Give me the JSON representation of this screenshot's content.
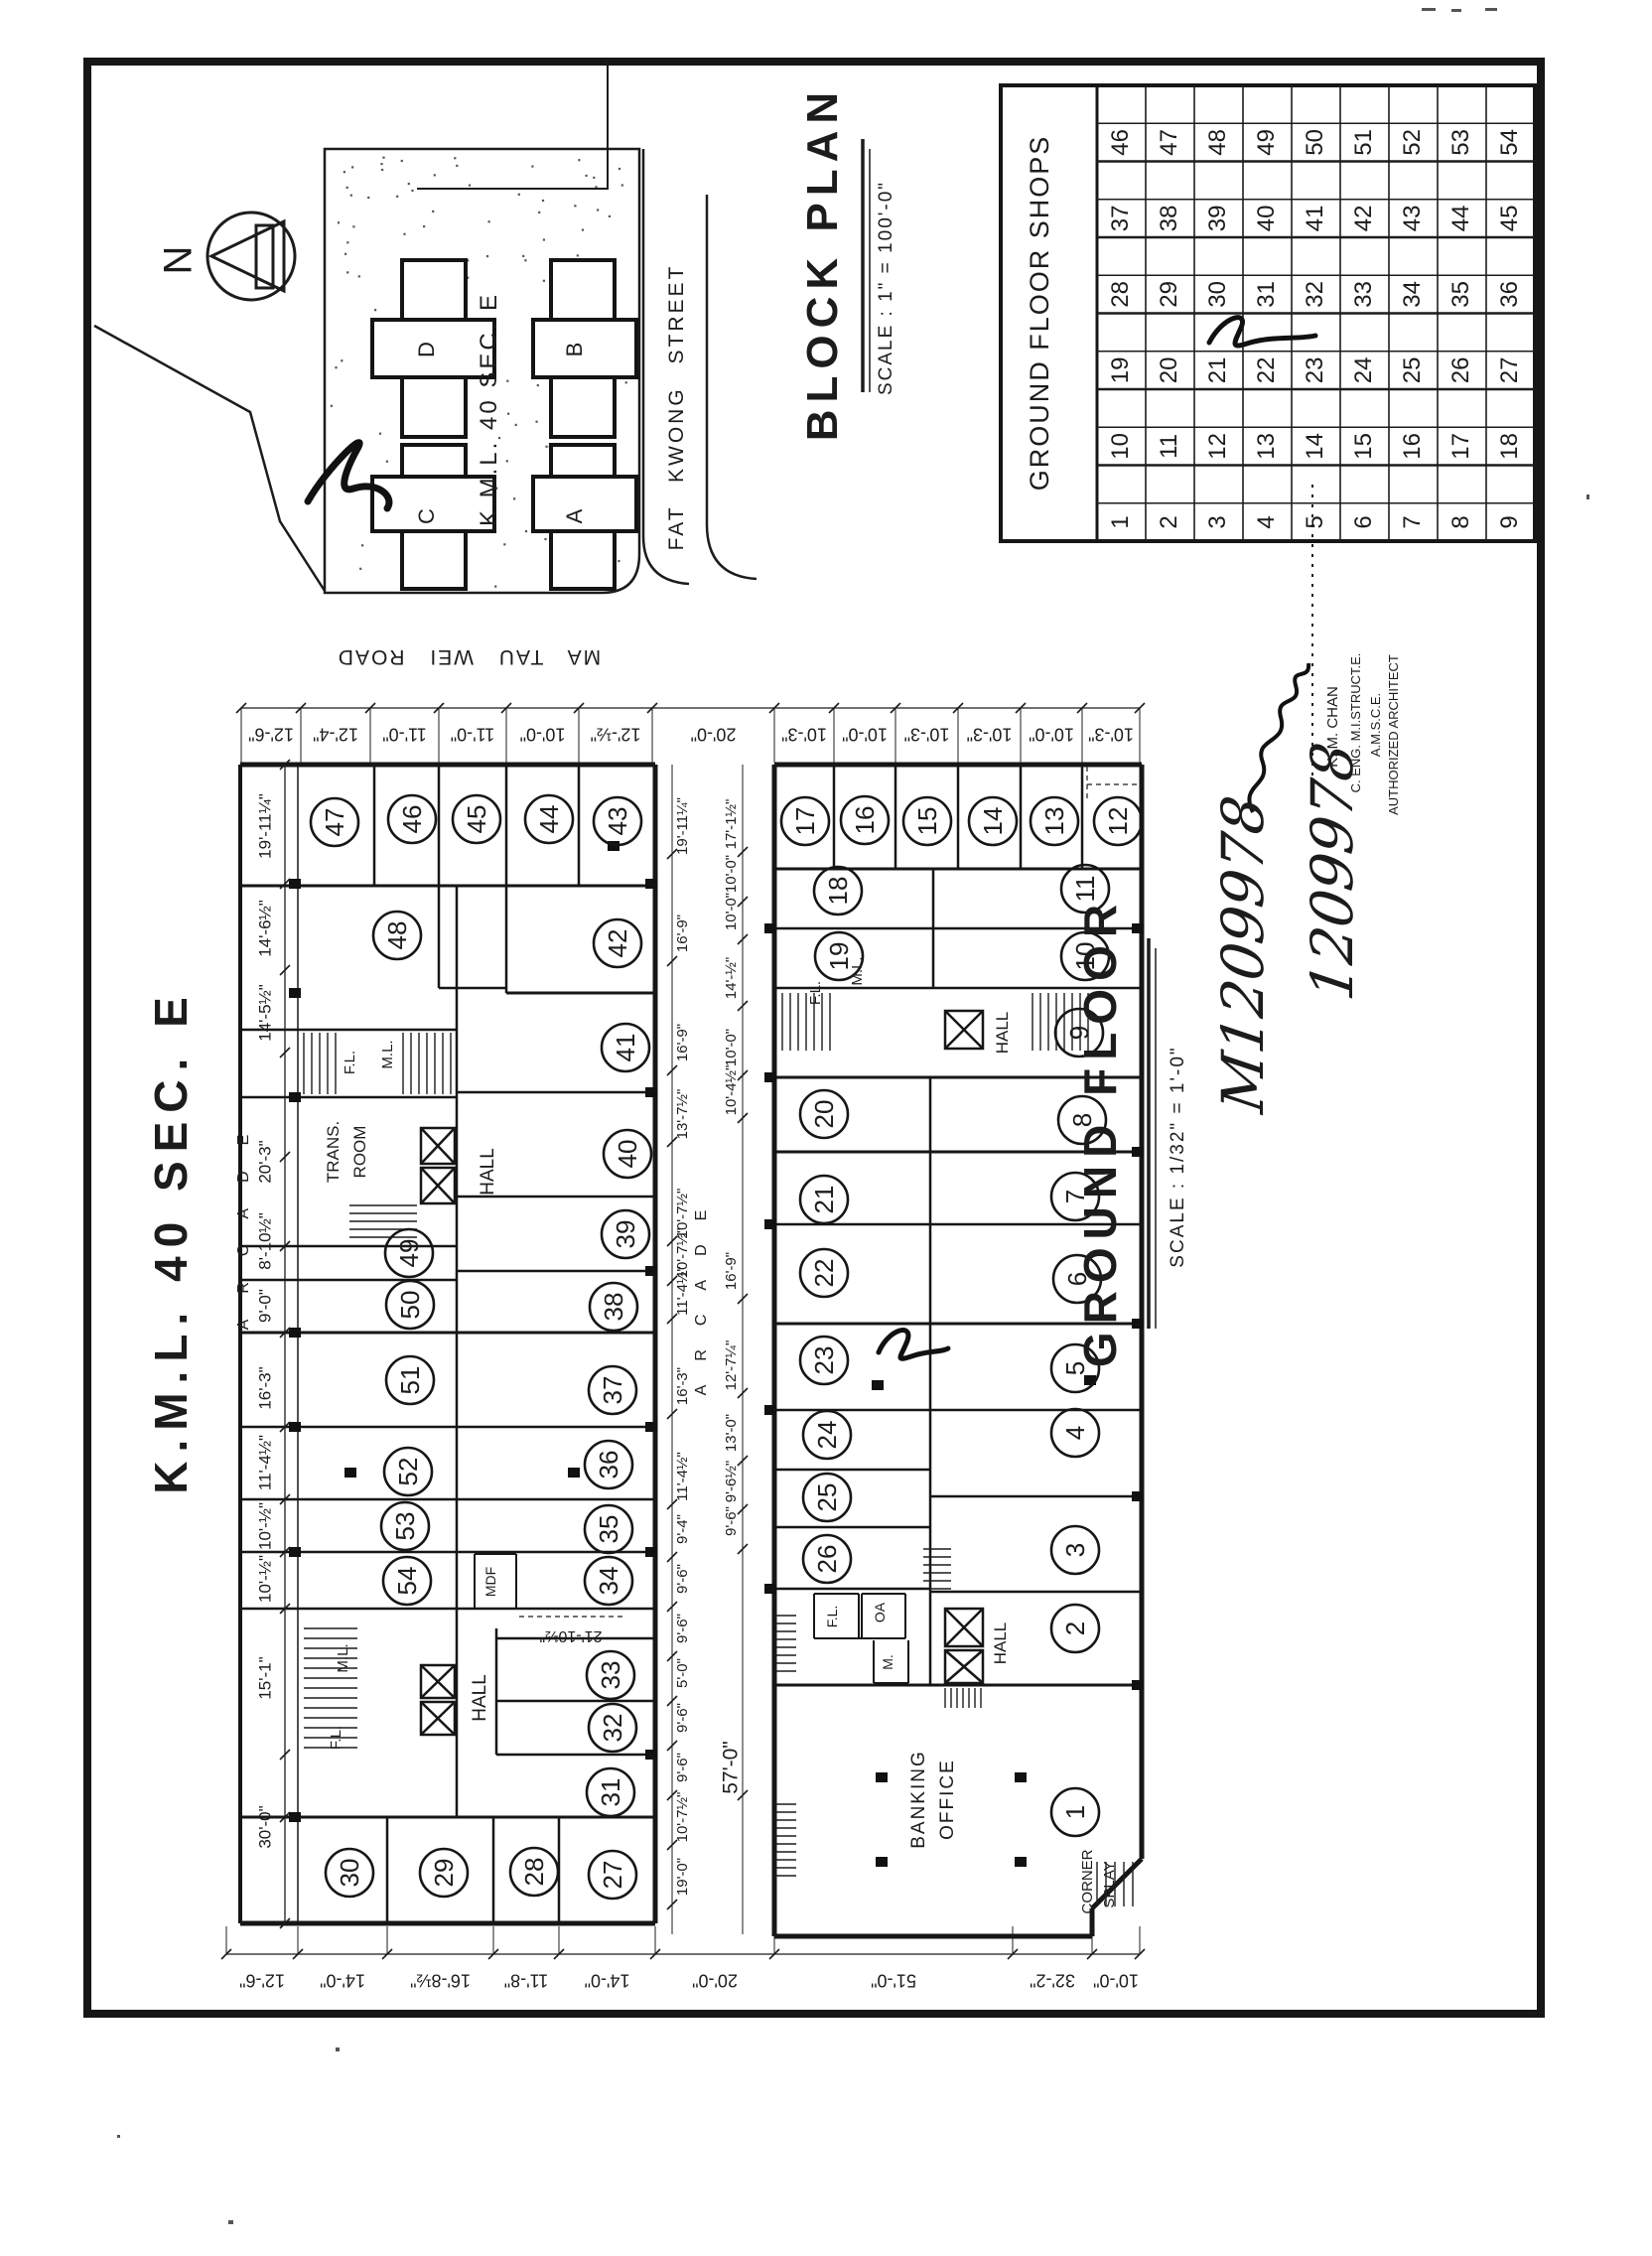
{
  "sheet": {
    "big_title": "K.M.L. 40 SEC. E",
    "arcade_label": "ARCADE"
  },
  "compass": {
    "north_label": "N"
  },
  "block_plan": {
    "title": "BLOCK PLAN",
    "scale": "SCALE : 1\" = 100'-0\"",
    "site_label": "K.M.L. 40 SEC. E",
    "building_a": "A",
    "building_b": "B",
    "building_c": "C",
    "building_d": "D",
    "street_bottom": "MA TAU WEI ROAD",
    "street_right": "FAT KWONG STREET"
  },
  "shops_table": {
    "header": "GROUND FLOOR SHOPS",
    "rows": [
      [
        "46",
        "47",
        "48",
        "49",
        "50",
        "51",
        "52",
        "53",
        "54"
      ],
      [
        "37",
        "38",
        "39",
        "40",
        "41",
        "42",
        "43",
        "44",
        "45"
      ],
      [
        "28",
        "29",
        "30",
        "31",
        "32",
        "33",
        "34",
        "35",
        "36"
      ],
      [
        "19",
        "20",
        "21",
        "22",
        "23",
        "24",
        "25",
        "26",
        "27"
      ],
      [
        "10",
        "11",
        "12",
        "13",
        "14",
        "15",
        "16",
        "17",
        "18"
      ],
      [
        "1",
        "2",
        "3",
        "4",
        "5",
        "6",
        "7",
        "8",
        "9"
      ]
    ]
  },
  "floor_plan": {
    "title": "GROUND FLOOR",
    "scale": "SCALE : 1/32\" = 1'-0\"",
    "shop_numbers": [
      "1",
      "2",
      "3",
      "4",
      "5",
      "6",
      "7",
      "8",
      "9",
      "10",
      "11",
      "12",
      "13",
      "14",
      "15",
      "16",
      "17",
      "18",
      "19",
      "20",
      "21",
      "22",
      "23",
      "24",
      "25",
      "26",
      "27",
      "28",
      "29",
      "30",
      "31",
      "32",
      "33",
      "34",
      "35",
      "36",
      "37",
      "38",
      "39",
      "40",
      "41",
      "42",
      "43",
      "44",
      "45",
      "46",
      "47",
      "48",
      "49",
      "50",
      "51",
      "52",
      "53",
      "54"
    ],
    "rooms": {
      "trans_line1": "TRANS.",
      "trans_line2": "ROOM",
      "hall": "HALL",
      "ml": "M.L.",
      "fl": "F.L.",
      "mdf": "MDF",
      "oa": "OA",
      "m": "M.",
      "banking_line1": "BANKING",
      "banking_line2": "OFFICE",
      "corner_line1": "CORNER",
      "corner_line2": "SPLAY"
    }
  },
  "dimensions": {
    "top_row": [
      "12'-6\"",
      "12'-4\"",
      "11'-0\"",
      "11'-0\"",
      "10'-0\"",
      "12'-½\"",
      "20'-0\"",
      "10'-3\"",
      "10'-0\"",
      "10'-3\"",
      "10'-3\"",
      "10'-0\"",
      "10'-3\""
    ],
    "bottom_row": [
      "12'-6\"",
      "14'-0\"",
      "16'-8½\"",
      "11'-8\"",
      "14'-0\"",
      "20'-0\"",
      "51'-0\"",
      "32'-2\"",
      "10'-0\""
    ],
    "left_col": [
      "19'-11¼\"",
      "14'-6½\"",
      "14'-5½\"",
      "20'-3\"",
      "8'-10½\"",
      "9'-0\"",
      "16'-3\"",
      "11'-4½\"",
      "10'-½\"",
      "10'-½\"",
      "15'-1\"",
      "30'-0\""
    ],
    "arcade_left_col": [
      "19'-11¼\"",
      "16'-9\"",
      "16'-9\"",
      "13'-7½\"",
      "10'-7½\"",
      "10'-7½\"",
      "11'-4½\"",
      "16'-3\"",
      "11'-4½\"",
      "9'-4\"",
      "9'-6\"",
      "9'-6\"",
      "5'-0\"",
      "9'-6\"",
      "9'-6\"",
      "10'-7½\"",
      "19'-0\""
    ],
    "arcade_right_col": [
      "17'-1½\"",
      "10'-0\"",
      "10'-0\"",
      "14'-½\"",
      "10'-0\"",
      "10'-4½\"",
      "16'-9\"",
      "12'-7¼\"",
      "13'-0\"",
      "9'-6½\"",
      "9'-6\"",
      "57'-0\""
    ],
    "extra_dim": "21'-10½\""
  },
  "annotations": {
    "signature_line1": "K. M. CHAN",
    "signature_line2": "C. ENG. M.I.STRUCT.E.",
    "signature_line3": "A.M.S.C.E.",
    "signature_line4": "AUTHORIZED ARCHITECT",
    "handwritten_number1": "M1209978",
    "handwritten_number2": "1209978"
  }
}
